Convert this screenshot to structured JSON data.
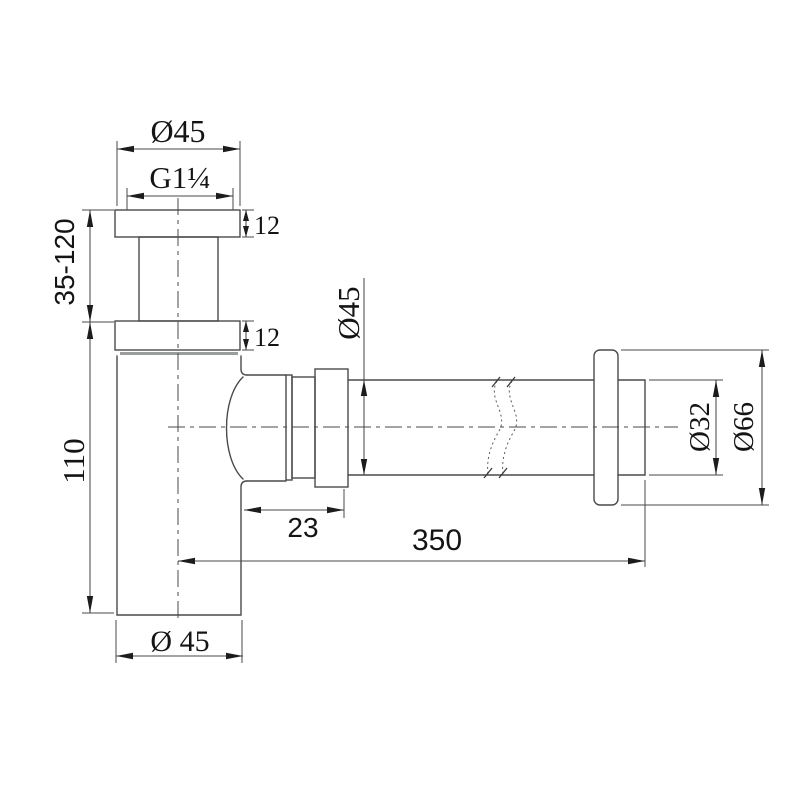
{
  "drawing": {
    "type": "technical-drawing",
    "subject": "bottle trap siphon with wall outlet",
    "colors": {
      "background": "#ffffff",
      "line": "#4a4a4a",
      "seal_line": "#9a9e9e",
      "text": "#141414"
    }
  },
  "dimensions": {
    "top_diameter": "Ø45",
    "thread_size": "G1¼",
    "upper_flange_thickness": "12",
    "lower_flange_thickness": "12",
    "inlet_adjustable_height": "35-120",
    "body_height": "110",
    "outlet_pipe_diameter": "Ø45",
    "outlet_offset": "23",
    "outlet_length": "350",
    "tailpipe_diameter": "Ø32",
    "wall_flange_diameter": "Ø66",
    "body_diameter": "Ø 45"
  }
}
